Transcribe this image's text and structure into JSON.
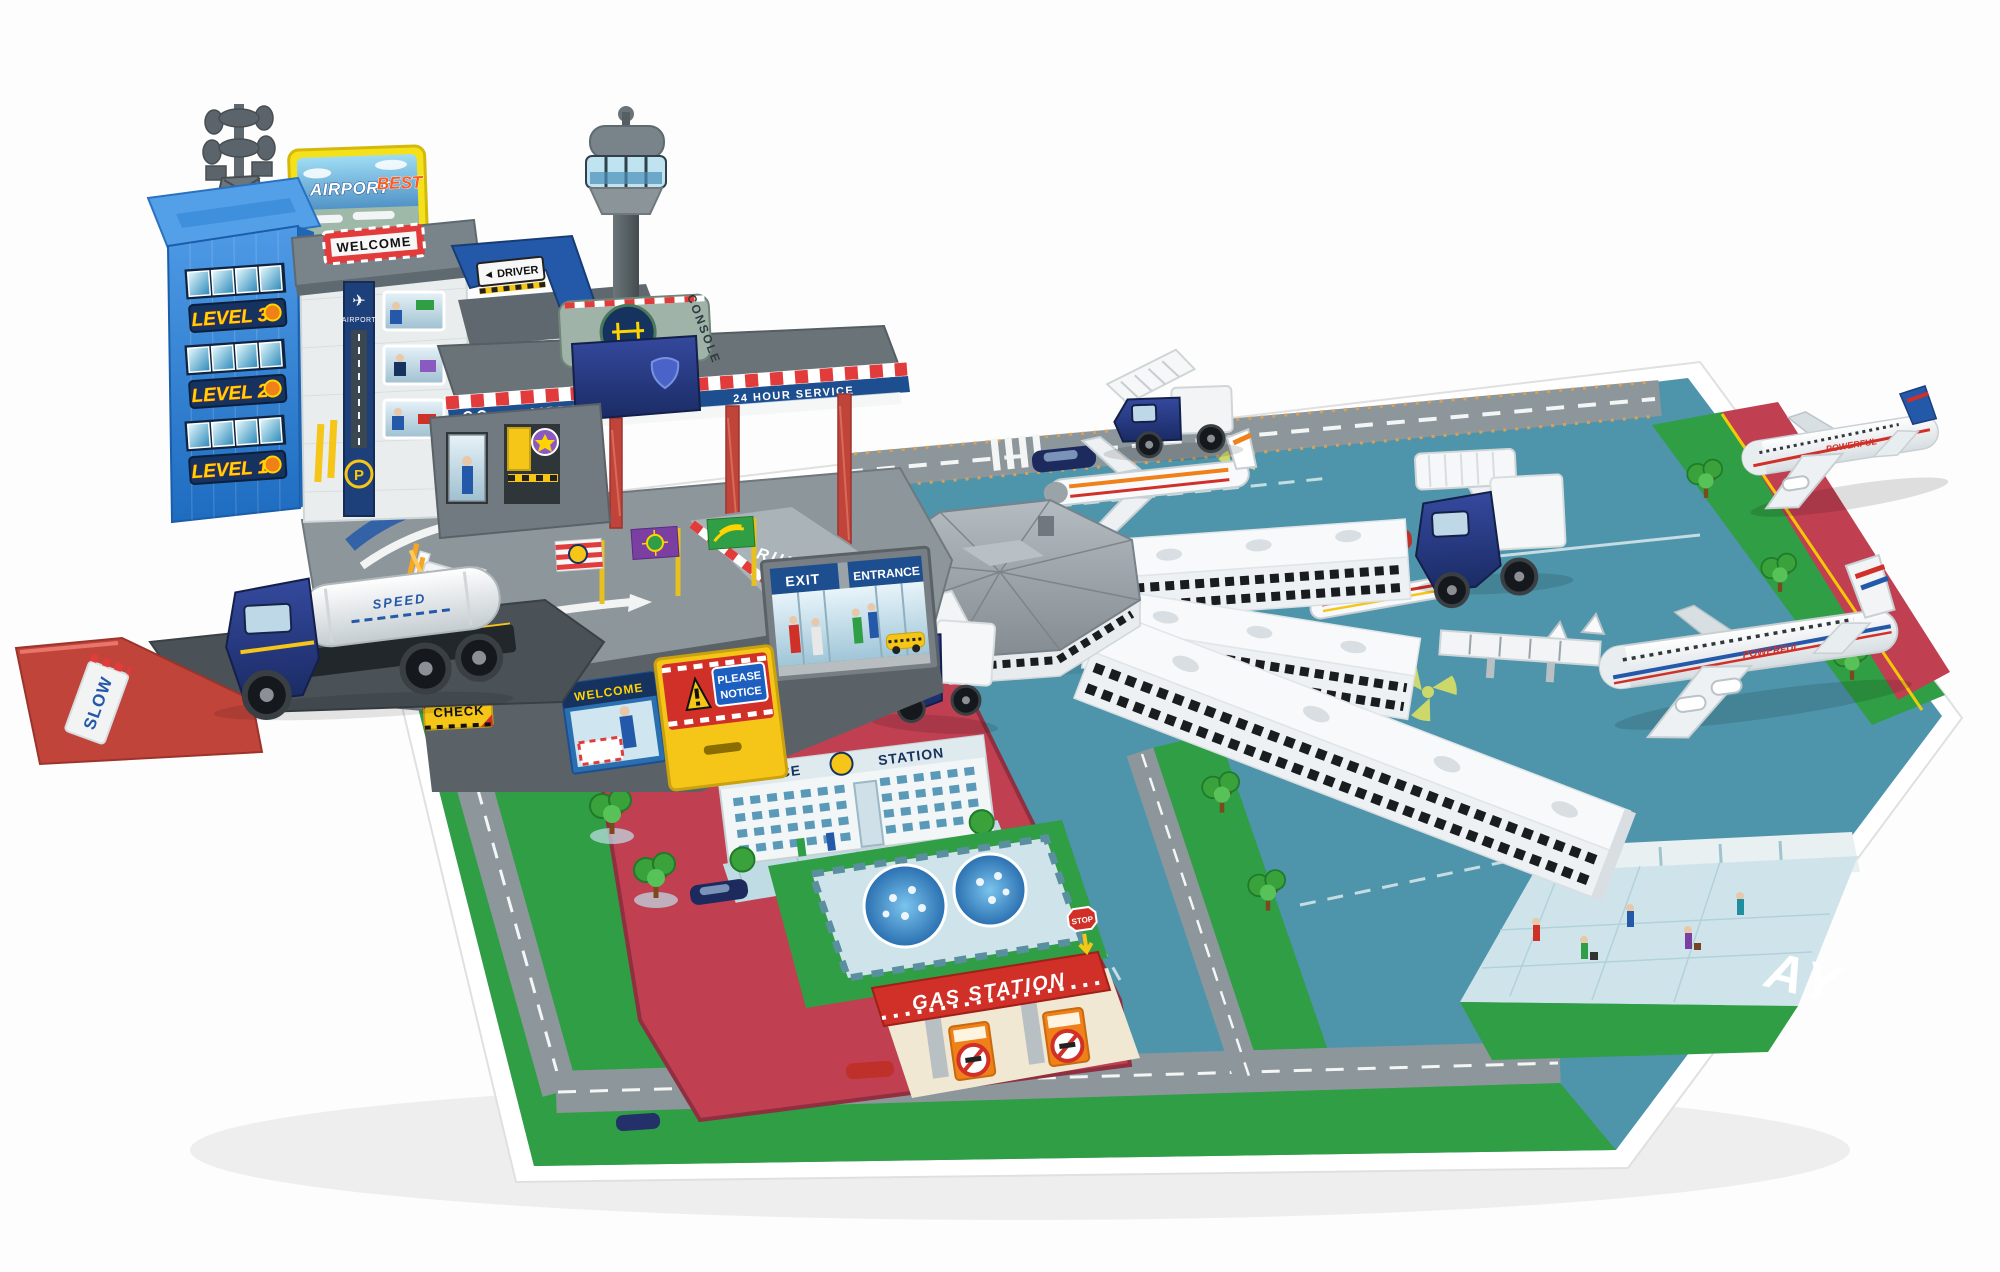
{
  "signs": {
    "billboard": {
      "airport": "AIRPORT",
      "best": "BEST"
    },
    "tower_levels": [
      "LEVEL 3",
      "LEVEL 2",
      "LEVEL 1"
    ],
    "garage": {
      "roof_welcome": "WELCOME",
      "banner_airport": "AIRPORT",
      "parking": "P"
    },
    "bridge_driver": "◄ DRIVER",
    "console": "CONSOLE",
    "canopy": {
      "airport": "AIRPORT",
      "service": "24 HOUR SERVICE"
    },
    "storefront": {
      "exit": "EXIT",
      "entrance": "ENTRANCE"
    },
    "notice_door": {
      "line1": "PLEASE",
      "line2": "NOTICE",
      "welcome": "WELCOME"
    },
    "ramp_runway": "RUNWAY",
    "check": "CHECK",
    "slow": "SLOW",
    "stop": "STOP",
    "gas_station": "GAS STATION",
    "police_station": {
      "police": "POLICE",
      "station": "STATION"
    },
    "mat_runway_fragment": "AY",
    "liveries": {
      "plane": "POWERFUL",
      "truck": "POWERFUL",
      "tanker": "SPEED"
    }
  },
  "colors": {
    "tower_blue": "#2f85d6",
    "mat_green": "#2f9e44",
    "mat_teal": "#4e95ab",
    "zone_red": "#c04052",
    "column_red": "#c0443a",
    "accent_yellow": "#f5c518",
    "banner_navy": "#1d4e8f",
    "canopy_grey": "#6a7478"
  }
}
